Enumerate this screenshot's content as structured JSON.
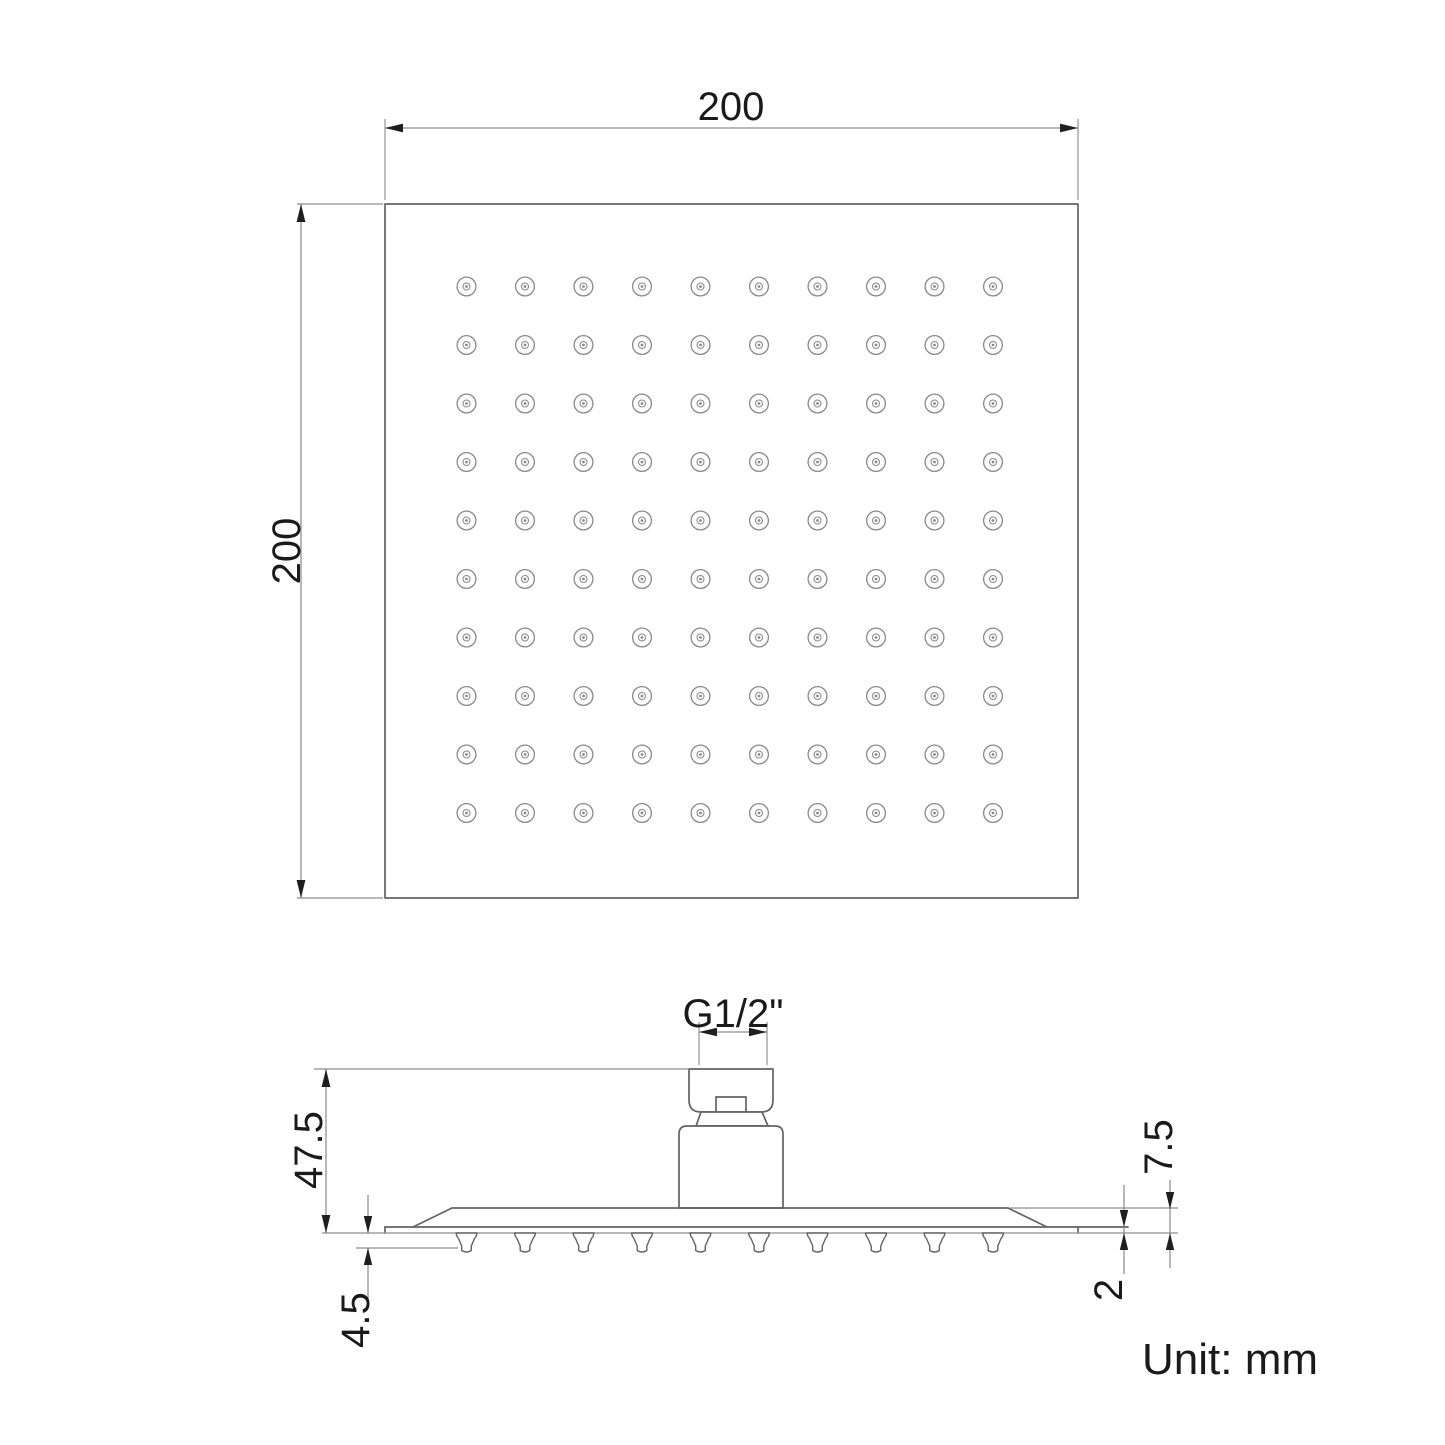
{
  "drawing": {
    "top_view": {
      "width_label": "200",
      "height_label": "200",
      "nozzle_grid": {
        "rows": 10,
        "cols": 10
      }
    },
    "side_view": {
      "thread_label": "G1/2\"",
      "overall_height_label": "47.5",
      "nozzle_protrusion_label": "4.5",
      "edge_height_label": "7.5",
      "plate_thickness_label": "2",
      "nozzle_count": 10
    },
    "unit_note": "Unit: mm",
    "colors": {
      "background": "#ffffff",
      "outline": "#636363",
      "thin_line": "#8d8d8d",
      "text": "#1a1a1a",
      "arrow": "#1f1f1f"
    }
  }
}
